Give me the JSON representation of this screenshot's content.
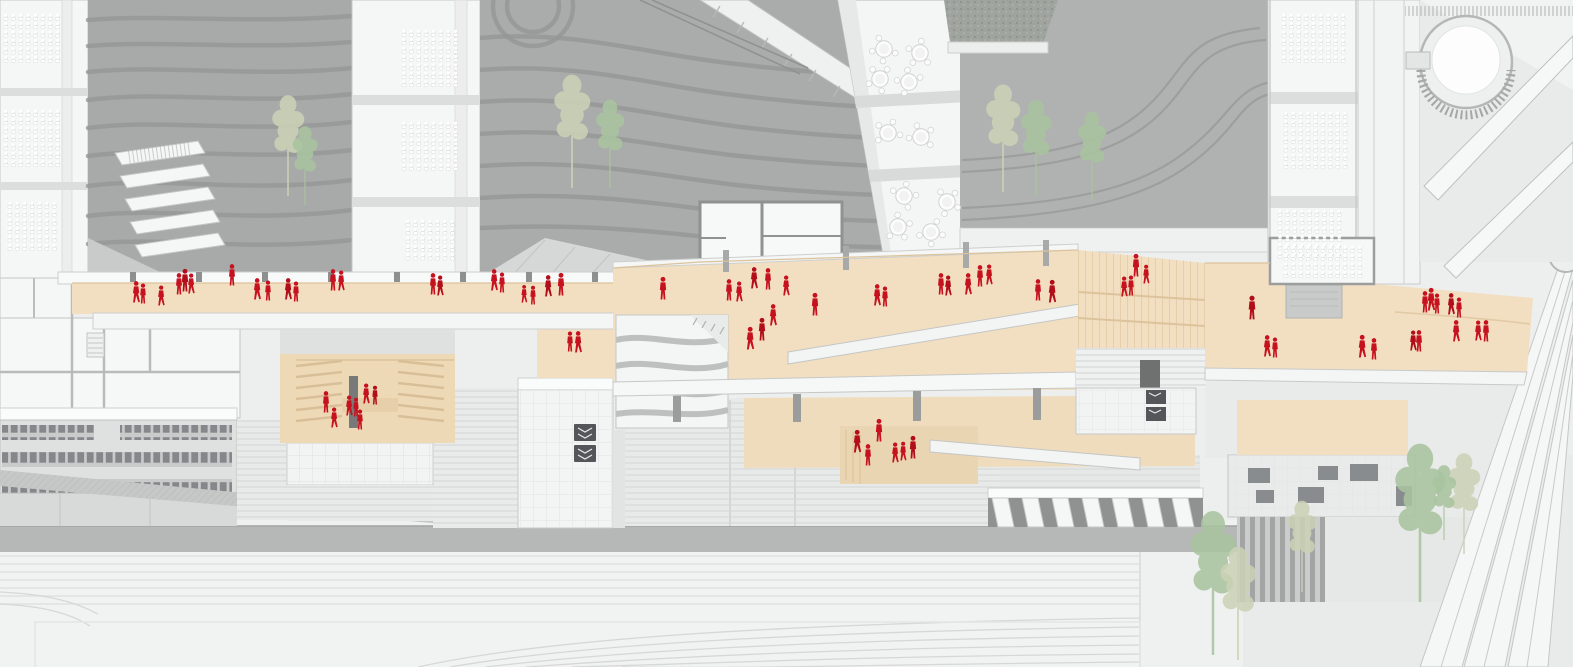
{
  "scene": {
    "people_color_meaning": "pedestrian-figures",
    "promenade_color_meaning": "highlighted-public-walkway"
  },
  "colors": {
    "background": "#edeeee",
    "plaza_light": "#f0f1f1",
    "road_band": "#b6b8b7",
    "courtyard_grey": "#a8aaa9",
    "courtyard_grey2": "#aaacab",
    "courtyard_grey3": "#b0b2b1",
    "contour_line": "#949796",
    "building_white": "#f5f6f6",
    "building_edge": "#c5c7c6",
    "promenade_beige": "#f2dfc1",
    "promenade_beige_low": "#efdcbc",
    "promenade_beige_deep": "#ead5b2",
    "figure_red": "#c6111e",
    "figure_red_dark": "#b20e19",
    "tree_green": "#a9c49f",
    "tree_pale": "#ccd2b6",
    "glyph_dark": "#54575a",
    "window_dark": "#85888b"
  },
  "people": [
    [
      136,
      303,
      0.85,
      1
    ],
    [
      143,
      304,
      0.8,
      0
    ],
    [
      161,
      306,
      0.8,
      1
    ],
    [
      179,
      295,
      0.85,
      0
    ],
    [
      185,
      292,
      0.9,
      0
    ],
    [
      191,
      294,
      0.8,
      1
    ],
    [
      232,
      286,
      0.85,
      0
    ],
    [
      257,
      300,
      0.85,
      1
    ],
    [
      268,
      301,
      0.8,
      0
    ],
    [
      288,
      300,
      0.85,
      1
    ],
    [
      296,
      302,
      0.8,
      0
    ],
    [
      333,
      291,
      0.85,
      0
    ],
    [
      341,
      291,
      0.8,
      1
    ],
    [
      433,
      295,
      0.85,
      0
    ],
    [
      440,
      296,
      0.8,
      1
    ],
    [
      494,
      291,
      0.85,
      1
    ],
    [
      502,
      293,
      0.8,
      0
    ],
    [
      524,
      303,
      0.7,
      1
    ],
    [
      533,
      305,
      0.75,
      0
    ],
    [
      548,
      297,
      0.85,
      1
    ],
    [
      561,
      296,
      0.9,
      0
    ],
    [
      663,
      300,
      0.9,
      0
    ],
    [
      729,
      301,
      0.85,
      0
    ],
    [
      739,
      302,
      0.8,
      1
    ],
    [
      754,
      289,
      0.85,
      1
    ],
    [
      768,
      290,
      0.85,
      0
    ],
    [
      786,
      296,
      0.8,
      1
    ],
    [
      815,
      316,
      0.9,
      0
    ],
    [
      773,
      326,
      0.85,
      1
    ],
    [
      762,
      341,
      0.9,
      0
    ],
    [
      750,
      350,
      0.9,
      1
    ],
    [
      877,
      306,
      0.85,
      1
    ],
    [
      885,
      307,
      0.8,
      0
    ],
    [
      941,
      295,
      0.85,
      0
    ],
    [
      948,
      296,
      0.8,
      1
    ],
    [
      968,
      295,
      0.85,
      1
    ],
    [
      980,
      287,
      0.85,
      0
    ],
    [
      989,
      285,
      0.8,
      1
    ],
    [
      1038,
      301,
      0.85,
      0
    ],
    [
      1052,
      303,
      0.9,
      1
    ],
    [
      1124,
      297,
      0.8,
      1
    ],
    [
      1131,
      296,
      0.8,
      0
    ],
    [
      1136,
      277,
      0.9,
      0
    ],
    [
      1146,
      284,
      0.75,
      1
    ],
    [
      1252,
      320,
      0.95,
      0
    ],
    [
      1267,
      357,
      0.85,
      1
    ],
    [
      1275,
      358,
      0.8,
      0
    ],
    [
      1362,
      358,
      0.9,
      1
    ],
    [
      1374,
      360,
      0.85,
      0
    ],
    [
      1413,
      351,
      0.8,
      1
    ],
    [
      1419,
      352,
      0.85,
      0
    ],
    [
      1425,
      313,
      0.85,
      0
    ],
    [
      1431,
      311,
      0.9,
      1
    ],
    [
      1437,
      314,
      0.8,
      0
    ],
    [
      1451,
      315,
      0.85,
      1
    ],
    [
      1459,
      318,
      0.8,
      0
    ],
    [
      1456,
      342,
      0.85,
      1
    ],
    [
      1478,
      341,
      0.8,
      1
    ],
    [
      1486,
      342,
      0.85,
      0
    ],
    [
      857,
      453,
      0.9,
      1
    ],
    [
      868,
      466,
      0.85,
      0
    ],
    [
      879,
      442,
      0.9,
      0
    ],
    [
      895,
      463,
      0.8,
      1
    ],
    [
      903,
      461,
      0.75,
      1
    ],
    [
      913,
      459,
      0.9,
      0
    ],
    [
      326,
      413,
      0.85,
      0
    ],
    [
      349,
      416,
      0.8,
      1
    ],
    [
      356,
      417,
      0.75,
      0
    ],
    [
      366,
      404,
      0.8,
      1
    ],
    [
      375,
      405,
      0.75,
      0
    ],
    [
      334,
      428,
      0.8,
      1
    ],
    [
      360,
      430,
      0.8,
      0
    ],
    [
      570,
      352,
      0.8,
      0
    ],
    [
      578,
      353,
      0.85,
      1
    ]
  ],
  "trees": [
    [
      288,
      196,
      105,
      0
    ],
    [
      305,
      205,
      82,
      1
    ],
    [
      572,
      188,
      118,
      0
    ],
    [
      610,
      188,
      92,
      1
    ],
    [
      1003,
      192,
      112,
      0
    ],
    [
      1036,
      196,
      100,
      1
    ],
    [
      1092,
      200,
      92,
      1
    ],
    [
      1213,
      655,
      150,
      1
    ],
    [
      1238,
      660,
      118,
      0
    ],
    [
      1302,
      592,
      95,
      0
    ],
    [
      1420,
      602,
      165,
      1
    ],
    [
      1464,
      554,
      105,
      0
    ],
    [
      1444,
      540,
      78,
      1
    ]
  ],
  "round_tables": [
    [
      884,
      49
    ],
    [
      920,
      53
    ],
    [
      880,
      79
    ],
    [
      909,
      82
    ],
    [
      888,
      133
    ],
    [
      921,
      137
    ],
    [
      904,
      196
    ],
    [
      947,
      202
    ],
    [
      898,
      227
    ],
    [
      931,
      232
    ]
  ],
  "desk_grids": [
    {
      "x": 4,
      "y": 14,
      "c": 8,
      "r": 6
    },
    {
      "x": 4,
      "y": 110,
      "c": 8,
      "r": 7
    },
    {
      "x": 8,
      "y": 202,
      "c": 7,
      "r": 6
    },
    {
      "x": 402,
      "y": 30,
      "c": 8,
      "r": 7
    },
    {
      "x": 402,
      "y": 122,
      "c": 8,
      "r": 6
    },
    {
      "x": 406,
      "y": 220,
      "c": 7,
      "r": 5
    },
    {
      "x": 1282,
      "y": 14,
      "c": 9,
      "r": 6
    },
    {
      "x": 1284,
      "y": 112,
      "c": 9,
      "r": 7
    },
    {
      "x": 1278,
      "y": 210,
      "c": 9,
      "r": 6
    },
    {
      "x": 1284,
      "y": 246,
      "c": 11,
      "r": 4
    }
  ]
}
